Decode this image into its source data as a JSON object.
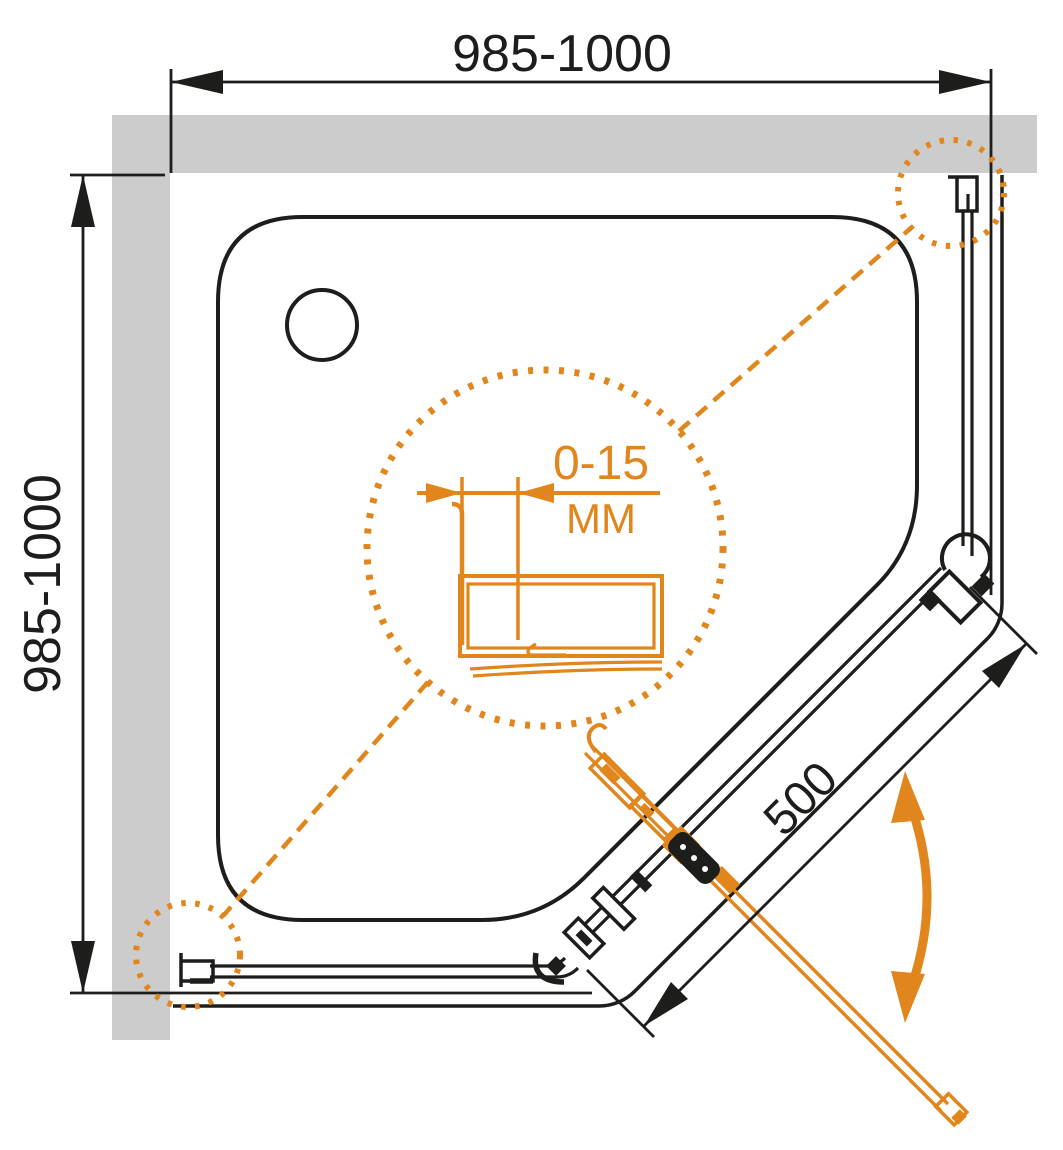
{
  "drawing": {
    "dimensions": {
      "width_top": "985-1000",
      "depth_left": "985-1000",
      "door_diagonal": "500",
      "wall_profile_adjustment": "0-15",
      "adjustment_unit": "ММ"
    },
    "colors": {
      "line": "#1D1D1B",
      "accent_orange": "#E0861C",
      "wall_gray": "#CCCCCC",
      "background": "#FFFFFF"
    }
  }
}
